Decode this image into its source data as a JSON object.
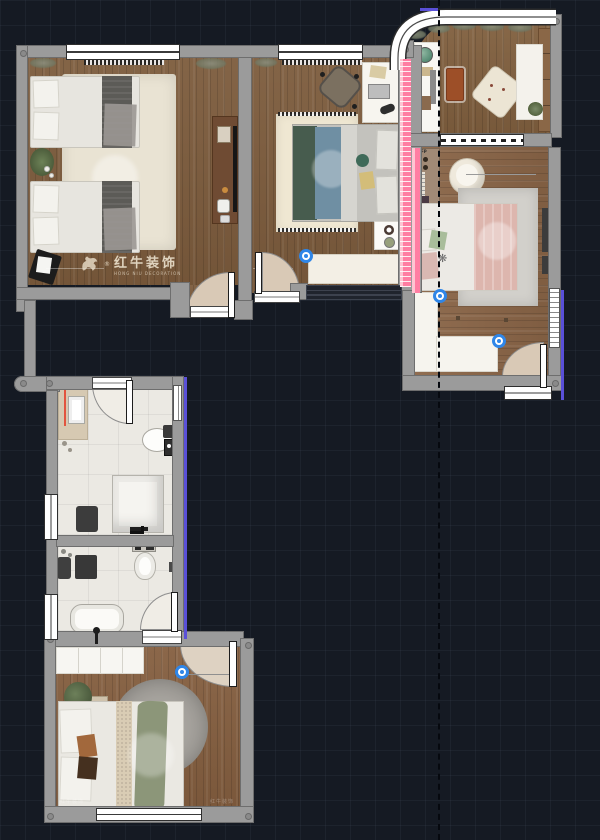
{
  "watermark": {
    "brand": "红牛装饰",
    "subtitle": "HONG NIU DECORATION",
    "registered": "®"
  },
  "corner_watermarks": {
    "left": "红牛装饰",
    "right": "红牛装饰"
  },
  "tags": {
    "wardrobe": "FP"
  },
  "palette": {
    "background": "#151a23",
    "grid": "#222937",
    "wall": "#9b9b9b",
    "wall_border": "#6e6e6e",
    "wood_floor": "#7d5c3d",
    "wood_floor_right": "#8a6547",
    "tile_floor": "#ebe9e3",
    "accent_pink": "#ff7da2",
    "accent_pink_light": "#ffc4d2",
    "accent_purple": "#5a50d8",
    "accent_red": "#e2543f",
    "marker_blue": "#2f86e8",
    "dashed_line": "#06090f"
  },
  "markers": {
    "count": 4,
    "style": "blue door-handle dots"
  }
}
